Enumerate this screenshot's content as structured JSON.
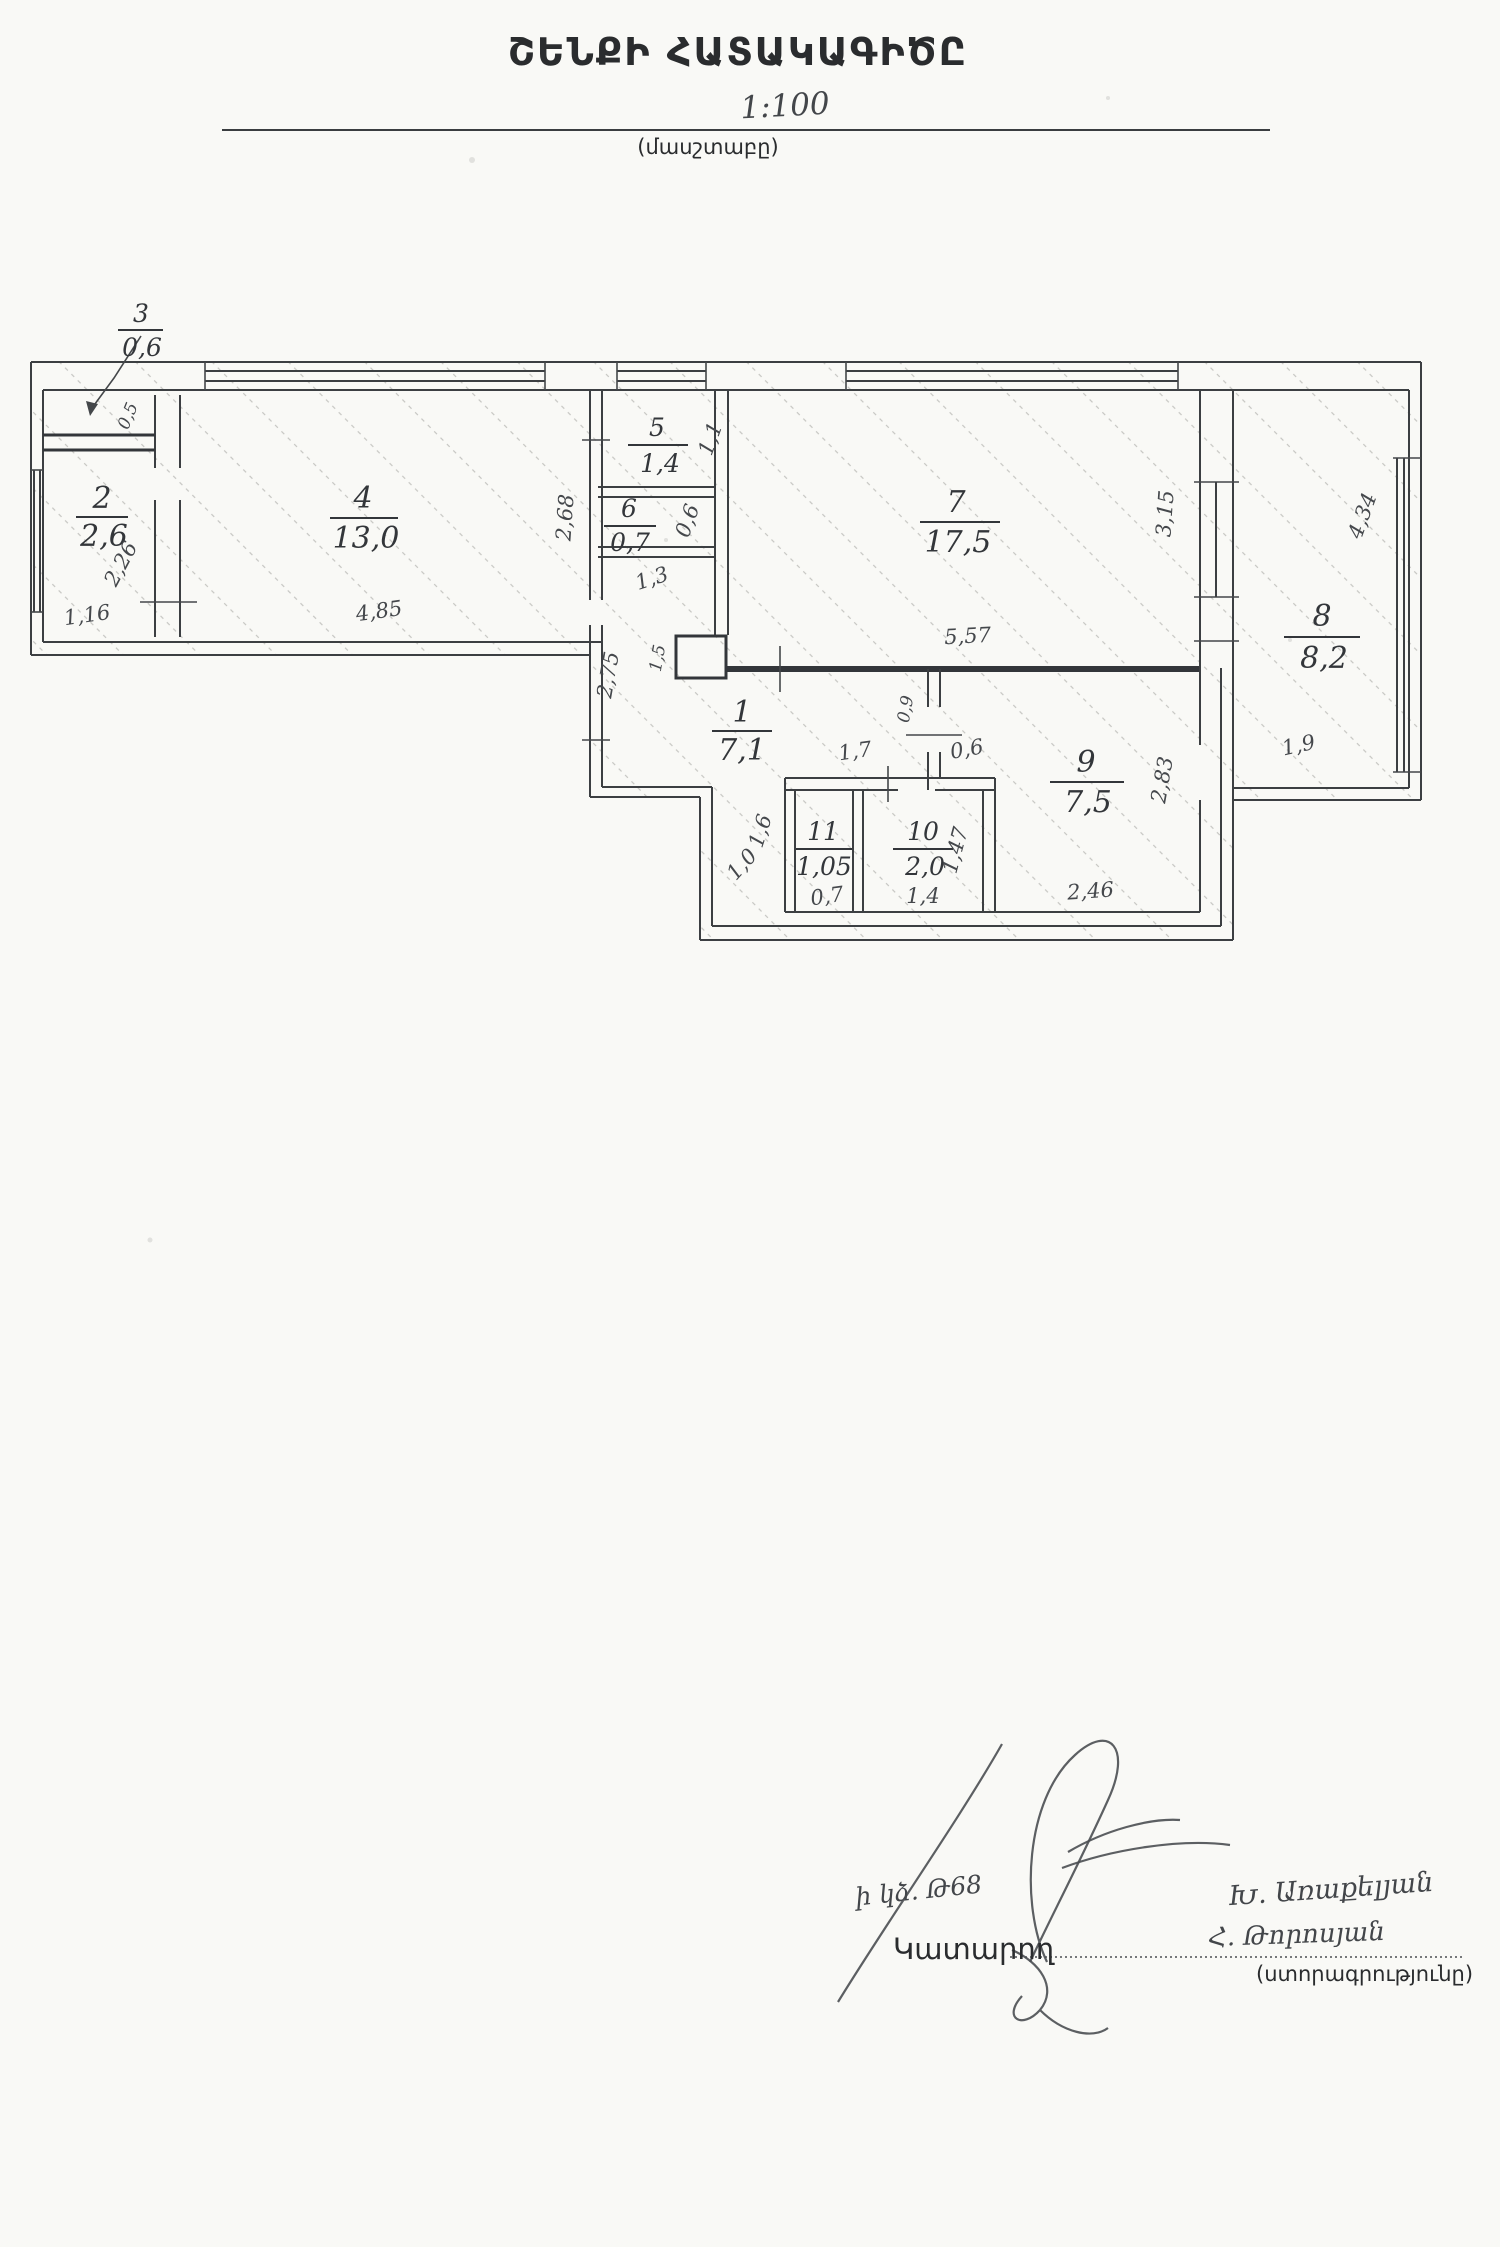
{
  "page": {
    "title": "ՇԵՆՔԻ ՀԱՏԱԿԱԳԻԾԸ",
    "scale_value": "1:100",
    "scale_caption": "(մասշտաբը)"
  },
  "plan": {
    "rooms": [
      {
        "number": "1",
        "area": "7,1"
      },
      {
        "number": "2",
        "area": "2,6"
      },
      {
        "number": "3",
        "area": "0,6"
      },
      {
        "number": "4",
        "area": "13,0"
      },
      {
        "number": "5",
        "area": "1,4"
      },
      {
        "number": "6",
        "area": "0,7"
      },
      {
        "number": "7",
        "area": "17,5"
      },
      {
        "number": "8",
        "area": "8,2"
      },
      {
        "number": "9",
        "area": "7,5"
      },
      {
        "number": "10",
        "area": "2,0"
      },
      {
        "number": "11",
        "area": "1,05"
      }
    ],
    "dimensions": {
      "room4_width": "4,85",
      "room4_left": "1,16",
      "room2_diag": "2,26",
      "room3_inner": "0,5",
      "hall_height": "2,68",
      "room5_depth": "1,1",
      "room6_depth": "0,6",
      "hall_width": "1,3",
      "room7_width": "5,57",
      "room7_right": "3,15",
      "room8_height": "4,34",
      "room8_bottom": "1,9",
      "room1_left": "2,75",
      "duct": "1,5",
      "wall9": "0,9",
      "door9": "0,6",
      "room11_top": "1,7",
      "room9_right": "2,83",
      "room9_bottom": "2,46",
      "room10_right": "1,47",
      "room10_bottom": "1,4",
      "room11_bottom": "0,7",
      "room11_left": "1,6",
      "corridor": "1,0"
    }
  },
  "signature_block": {
    "handwritten_note": "ի կձ. Թ68",
    "executor_label": "Կատարող",
    "name_top": "Խ. Առաքելյան",
    "name_bottom": "Հ. Թորոսյան",
    "caption": "(ստորագրությունը)"
  }
}
